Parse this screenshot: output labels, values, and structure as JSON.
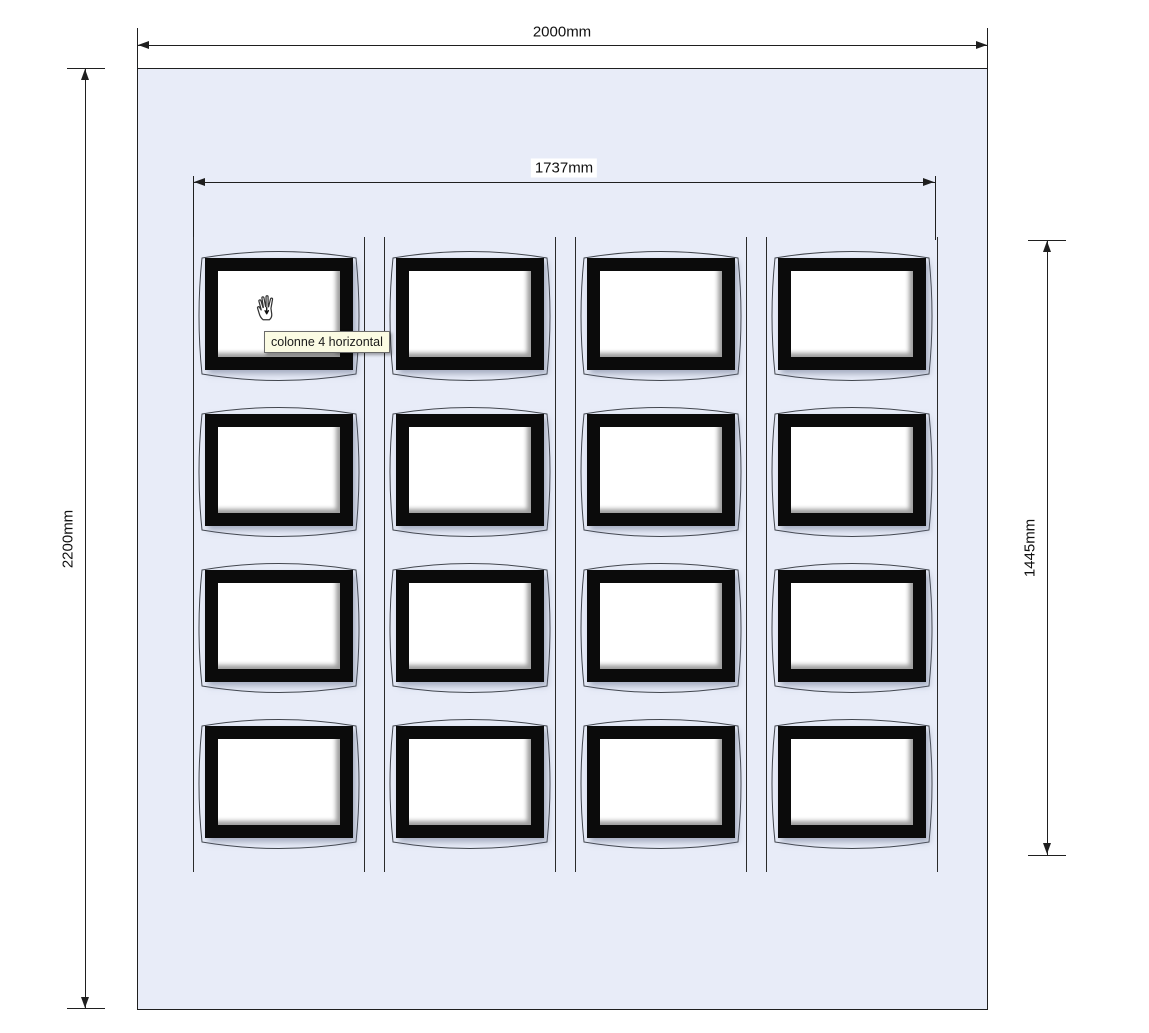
{
  "app": {
    "type": "panel-design-canvas"
  },
  "colors": {
    "panel_fill": "#e8ecf8",
    "line": "#1f1f1f",
    "frame": "#0b0b0b",
    "tooltip_bg": "#fbfbe3",
    "tooltip_border": "#6b6b6b"
  },
  "dimensions": {
    "overall_width": {
      "label": "2000mm"
    },
    "overall_height": {
      "label": "2200mm"
    },
    "grid_width": {
      "label": "1737mm"
    },
    "grid_height": {
      "label": "1445mm"
    }
  },
  "grid": {
    "columns": 4,
    "rows": 4
  },
  "tooltip": {
    "text": "colonne 4 horizontal"
  },
  "cursor": {
    "type": "pan-hand"
  }
}
